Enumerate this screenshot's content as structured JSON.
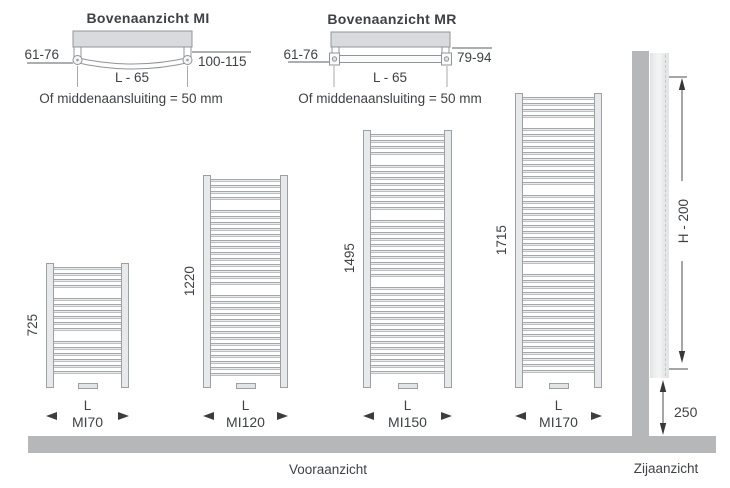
{
  "top_views": [
    {
      "title": "Bovenaanzicht MI",
      "left_dim": "61-76",
      "right_dim": "100-115",
      "length_dim": "L - 65",
      "note": "Of middenaansluiting = 50 mm",
      "tube_shape": "curved"
    },
    {
      "title": "Bovenaanzicht MR",
      "left_dim": "61-76",
      "right_dim": "79-94",
      "length_dim": "L - 65",
      "note": "Of middenaansluiting = 50 mm",
      "tube_shape": "straight"
    }
  ],
  "front_view": {
    "label": "Vooraanzicht",
    "radiators": [
      {
        "model": "MI70",
        "height_mm": "725",
        "length_label": "L",
        "geom": {
          "x": 46,
          "top": 263,
          "w": 83,
          "h": 125
        },
        "rung_groups": [
          4,
          6,
          6
        ]
      },
      {
        "model": "MI120",
        "height_mm": "1220",
        "length_label": "L",
        "geom": {
          "x": 203,
          "top": 175,
          "w": 85,
          "h": 213
        },
        "rung_groups": [
          4,
          13,
          14
        ]
      },
      {
        "model": "MI150",
        "height_mm": "1495",
        "length_label": "L",
        "geom": {
          "x": 363,
          "top": 130,
          "w": 89,
          "h": 258
        },
        "rung_groups": [
          4,
          8,
          10,
          15
        ]
      },
      {
        "model": "MI170",
        "height_mm": "1715",
        "length_label": "L",
        "geom": {
          "x": 515,
          "top": 93,
          "w": 87,
          "h": 295
        },
        "rung_groups": [
          4,
          10,
          12,
          17
        ]
      }
    ]
  },
  "side_view": {
    "label": "Zijaanzicht",
    "height_dim": "H - 200",
    "floor_clearance_dim": "250"
  },
  "colors": {
    "line": "#8f9497",
    "text": "#3e4246",
    "radiator_fill": "#e7e9ea",
    "collector_fill": "#d9dadb",
    "wall_floor": "#b5b7b9"
  }
}
